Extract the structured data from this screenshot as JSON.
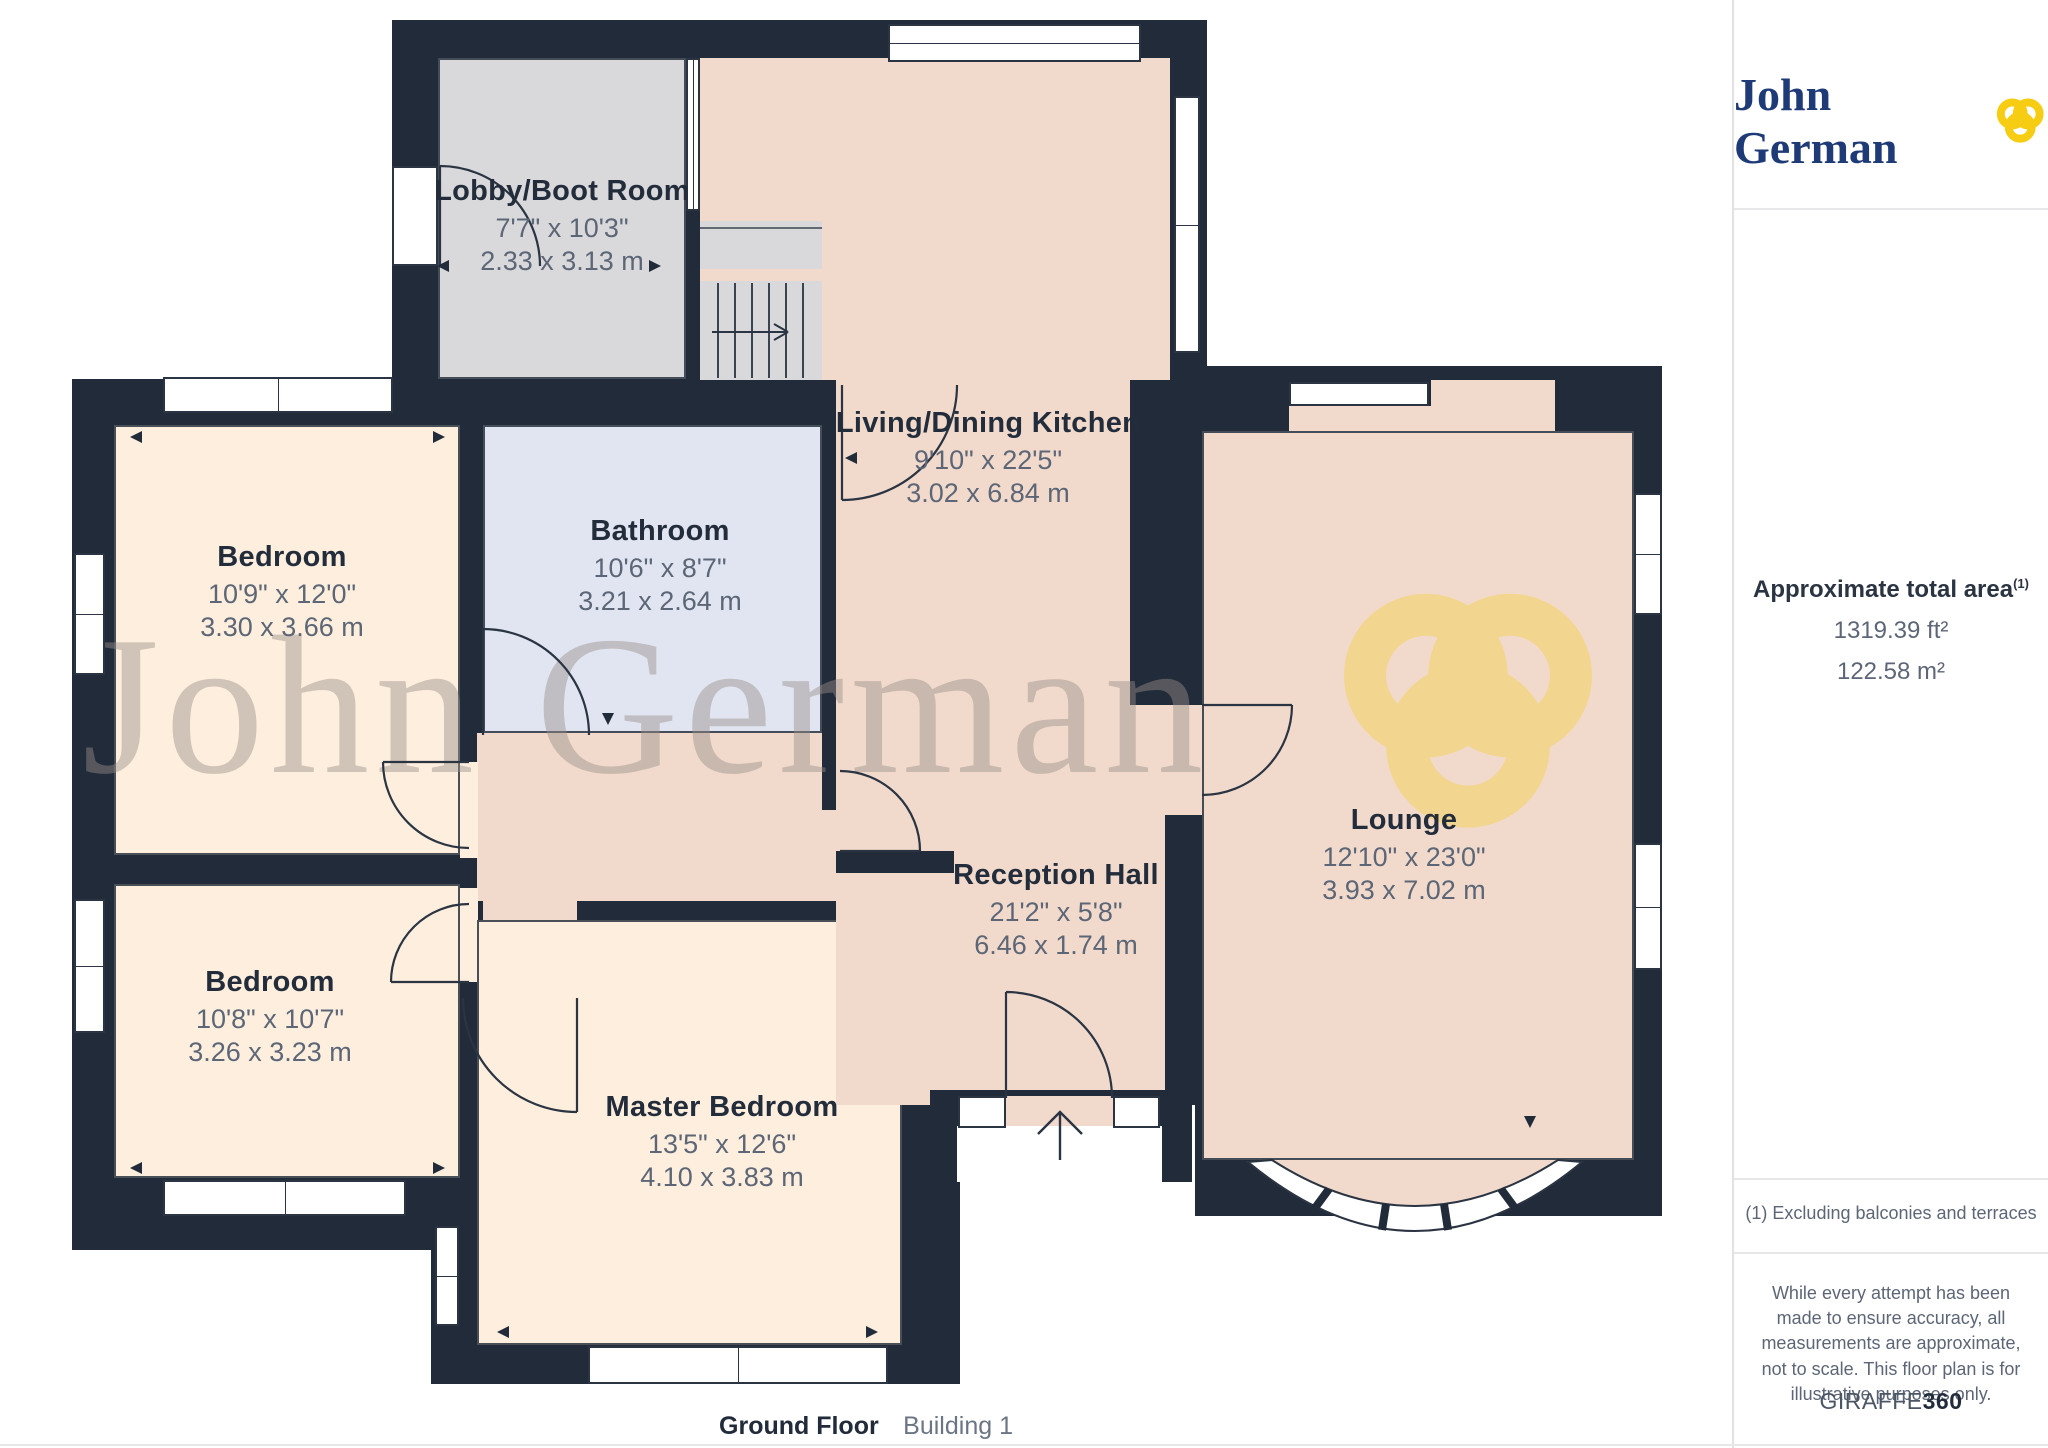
{
  "branding": {
    "logo_text": "John German"
  },
  "watermark": {
    "text": "John German"
  },
  "rooms": [
    {
      "name": "Lobby/Boot Room",
      "dims_ft": "7'7\" x 10'3\"",
      "dims_m": "2.33 x 3.13 m"
    },
    {
      "name": "Living/Dining Kitchen",
      "dims_ft": "9'10\" x 22'5\"",
      "dims_m": "3.02 x 6.84 m"
    },
    {
      "name": "Bedroom",
      "dims_ft": "10'9\" x 12'0\"",
      "dims_m": "3.30 x 3.66 m"
    },
    {
      "name": "Bathroom",
      "dims_ft": "10'6\" x 8'7\"",
      "dims_m": "3.21 x 2.64 m"
    },
    {
      "name": "Bedroom",
      "dims_ft": "10'8\" x 10'7\"",
      "dims_m": "3.26 x 3.23 m"
    },
    {
      "name": "Master Bedroom",
      "dims_ft": "13'5\" x 12'6\"",
      "dims_m": "4.10 x 3.83 m"
    },
    {
      "name": "Reception Hall",
      "dims_ft": "21'2\" x 5'8\"",
      "dims_m": "6.46 x 1.74 m"
    },
    {
      "name": "Lounge",
      "dims_ft": "12'10\" x 23'0\"",
      "dims_m": "3.93 x 7.02 m"
    }
  ],
  "sidebar": {
    "area_title": "Approximate total area",
    "area_superscript": "(1)",
    "area_ft": "1319.39 ft²",
    "area_m": "122.58 m²",
    "footnote": "(1) Excluding balconies and terraces",
    "disclaimer": "While every attempt has been made to ensure accuracy, all measurements are approximate, not to scale. This floor plan is for illustrative purposes only.",
    "brand_footer_regular": "GIRAFFE",
    "brand_footer_bold": "360"
  },
  "footer": {
    "floor_label": "Ground Floor",
    "building_label": "Building 1"
  },
  "colors": {
    "wall": "#212b3a",
    "floor_main": "#f1dacc",
    "floor_bedroom": "#fdeedd",
    "floor_bathroom": "#e0e5f1",
    "floor_lobby": "#d9d9db",
    "brand_navy": "#1f3b77",
    "brand_yellow": "#f7cd13"
  }
}
